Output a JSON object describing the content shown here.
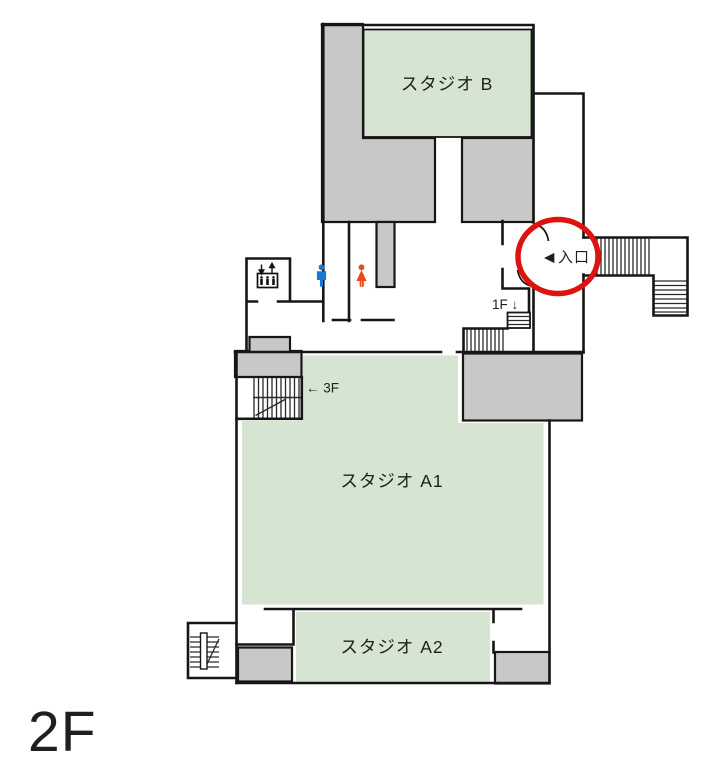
{
  "floor": {
    "label": "2F"
  },
  "rooms": {
    "studio_b": {
      "label": "スタジオ B"
    },
    "studio_a1": {
      "label": "スタジオ A1"
    },
    "studio_a2": {
      "label": "スタジオ A2"
    }
  },
  "annotations": {
    "entrance_label": "入口",
    "entrance_arrow": "◀",
    "stairs_down_1f": "1F ↓",
    "stairs_up_3f": "← 3F"
  },
  "icons": {
    "elevator": "elevator-icon",
    "male_restroom": "male-restroom-icon",
    "female_restroom": "female-restroom-icon",
    "entrance_highlight": "entrance-highlight-circle"
  },
  "colors": {
    "room_green": "#d6e5d1",
    "block_gray": "#c8c8c8",
    "wall": "#161616",
    "highlight_red": "#de1310",
    "restroom_male_blue": "#1b78d0",
    "restroom_female_red": "#e8491e"
  }
}
